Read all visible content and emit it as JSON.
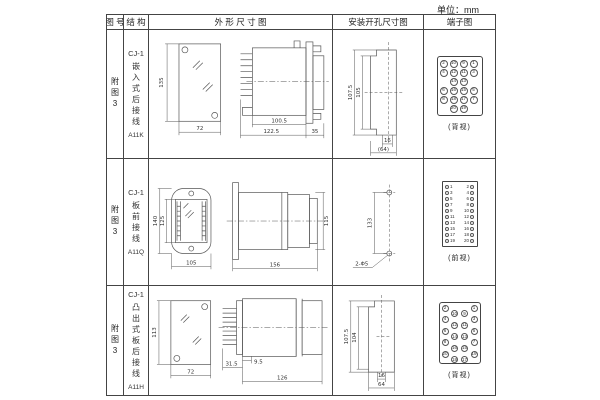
{
  "unit_label": "单位：mm",
  "table": {
    "headers": [
      "图 号",
      "结 构",
      "外 形 尺 寸 图",
      "安装开孔尺寸图",
      "端子图"
    ],
    "rows": [
      {
        "figure_no": "附图3",
        "structure_model": "CJ-1",
        "structure_desc": "嵌入式后接线",
        "structure_code": "A11K",
        "outline_dims": {
          "front_height": "135",
          "front_width": "72",
          "body_len": "100.5",
          "total_len": "122.5",
          "flange": "35"
        },
        "install_dims": {
          "outer_h": "107.5",
          "inner_h": "105",
          "slot_w": "16",
          "total_w": "(64)"
        },
        "terminal": {
          "caption": "(背视)",
          "rows": [
            [
              "2",
              "10",
              "9",
              "1"
            ],
            [
              "4",
              "12",
              "11",
              "3"
            ],
            [
              "",
              "14",
              "13",
              ""
            ],
            [
              "6",
              "16",
              "15",
              "5"
            ],
            [
              "8",
              "18",
              "17",
              "7"
            ],
            [
              "",
              "20",
              "19",
              ""
            ]
          ]
        }
      },
      {
        "figure_no": "附图3",
        "structure_model": "CJ-1",
        "structure_desc": "板前接线",
        "structure_code": "A11Q",
        "outline_dims": {
          "front_outer_h": "140",
          "front_inner_h": "125",
          "front_width": "105",
          "body_len": "156",
          "side_height": "115"
        },
        "install_dims": {
          "hole_spacing": "133",
          "hole_label": "2-Φ5"
        },
        "terminal": {
          "caption": "(前视)",
          "left": [
            "1",
            "3",
            "5",
            "7",
            "9",
            "11",
            "13",
            "15",
            "17",
            "19"
          ],
          "right": [
            "2",
            "4",
            "6",
            "8",
            "10",
            "12",
            "14",
            "16",
            "18",
            "20"
          ]
        }
      },
      {
        "figure_no": "附图3",
        "structure_model": "CJ-1",
        "structure_desc": "凸出式板后接线",
        "structure_code": "A11H",
        "outline_dims": {
          "front_height": "113",
          "front_width": "72",
          "pin_len": "31.5",
          "gap": "9.5",
          "body_len": "126"
        },
        "install_dims": {
          "outer_h": "107.5",
          "inner_h": "104",
          "slot_w": "16",
          "total_w": "64"
        },
        "terminal": {
          "caption": "(背视)",
          "outer_left": [
            "2",
            "4",
            "6",
            "8",
            "20"
          ],
          "inner_left": [
            "10",
            "12",
            "14",
            "16",
            "18"
          ],
          "inner_right": [
            "9",
            "11",
            "13",
            "15",
            "17"
          ],
          "outer_right": [
            "1",
            "3",
            "5",
            "7",
            "19"
          ]
        }
      }
    ]
  }
}
